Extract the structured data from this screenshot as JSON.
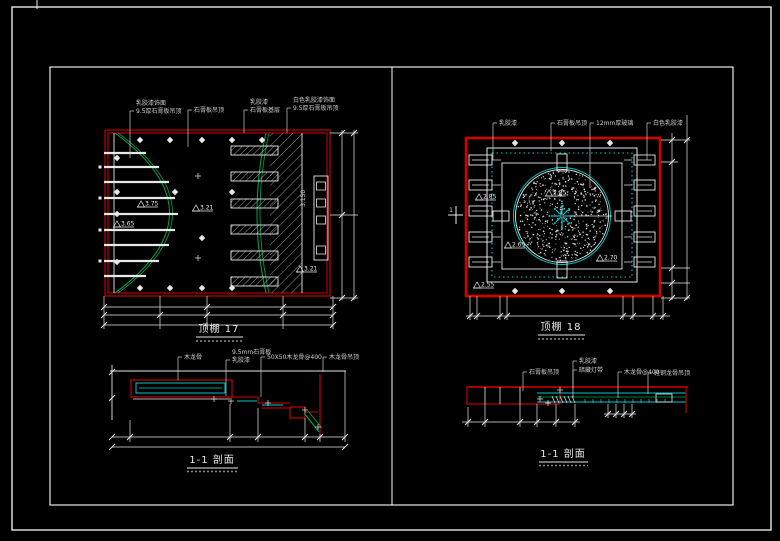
{
  "colors": {
    "background": "#000000",
    "line_white": "#e8e8e8",
    "line_red": "#d40000",
    "line_cyan": "#00c8c8",
    "line_green": "#00a651",
    "text_gray": "#cfcfcf"
  },
  "plan_left": {
    "title": "顶棚 17",
    "callouts": [
      {
        "lines": [
          "乳胶漆饰面",
          "9.5厚石膏板吊顶"
        ],
        "x": 130,
        "y1": 111,
        "y2": 158
      },
      {
        "lines": [
          "石膏板吊顶"
        ],
        "x": 188,
        "y1": 110,
        "y2": 147
      },
      {
        "lines": [
          "乳胶漆",
          "石膏板基层"
        ],
        "x": 244,
        "y1": 110,
        "y2": 133
      },
      {
        "lines": [
          "白色乳胶漆饰面",
          "9.5厚石膏板吊顶"
        ],
        "x": 287,
        "y1": 108,
        "y2": 133
      }
    ],
    "elevations": [
      {
        "v": "3.75",
        "x": 141,
        "y": 207
      },
      {
        "v": "3.65",
        "x": 117,
        "y": 227
      },
      {
        "v": "3.21",
        "x": 196,
        "y": 211
      },
      {
        "v": "3.21",
        "x": 300,
        "y": 272
      }
    ],
    "vertical_dim": "3.150"
  },
  "plan_right": {
    "title": "顶棚 18",
    "section_marker": "1",
    "callouts": [
      {
        "lines": [
          "乳胶漆"
        ],
        "x": 493,
        "y1": 123,
        "y2": 160
      },
      {
        "lines": [
          "石膏板吊顶"
        ],
        "x": 551,
        "y1": 123,
        "y2": 151
      },
      {
        "lines": [
          "12mm厚玻璃"
        ],
        "x": 590,
        "y1": 123,
        "y2": 188
      },
      {
        "lines": [
          "白色乳胶漆"
        ],
        "x": 647,
        "y1": 123,
        "y2": 160
      }
    ],
    "elevations": [
      {
        "v": "2.85",
        "x": 479,
        "y": 200
      },
      {
        "v": "2.85",
        "x": 549,
        "y": 196
      },
      {
        "v": "2.65",
        "x": 508,
        "y": 248
      },
      {
        "v": "2.70",
        "x": 600,
        "y": 261
      },
      {
        "v": "2.55",
        "x": 477,
        "y": 288
      }
    ]
  },
  "section_left": {
    "title": "1-1 剖面",
    "callouts": [
      {
        "lines": [
          "木龙骨"
        ],
        "x": 178,
        "y1": 357,
        "y2": 380
      },
      {
        "lines": [
          "9.5mm石膏板",
          "乳胶漆"
        ],
        "x": 226,
        "y1": 360,
        "y2": 396
      },
      {
        "lines": [
          "50X50木龙骨@400"
        ],
        "x": 261,
        "y1": 357,
        "y2": 397
      },
      {
        "lines": [
          "木龙骨吊顶"
        ],
        "x": 323,
        "y1": 357,
        "y2": 372
      }
    ]
  },
  "section_right": {
    "title": "1-1 剖面",
    "callouts": [
      {
        "lines": [
          "石膏板吊顶"
        ],
        "x": 523,
        "y1": 372,
        "y2": 391
      },
      {
        "lines": [
          "乳胶漆"
        ],
        "x": 573,
        "y1": 361,
        "y2": 389
      },
      {
        "lines": [
          "暗藏灯带"
        ],
        "x": 573,
        "y1": 370,
        "y2": 398
      },
      {
        "lines": [
          "木龙骨@400"
        ],
        "x": 618,
        "y1": 372,
        "y2": 398
      },
      {
        "lines": [
          "轻钢龙骨吊顶"
        ],
        "x": 648,
        "y1": 373,
        "y2": 394
      }
    ]
  }
}
